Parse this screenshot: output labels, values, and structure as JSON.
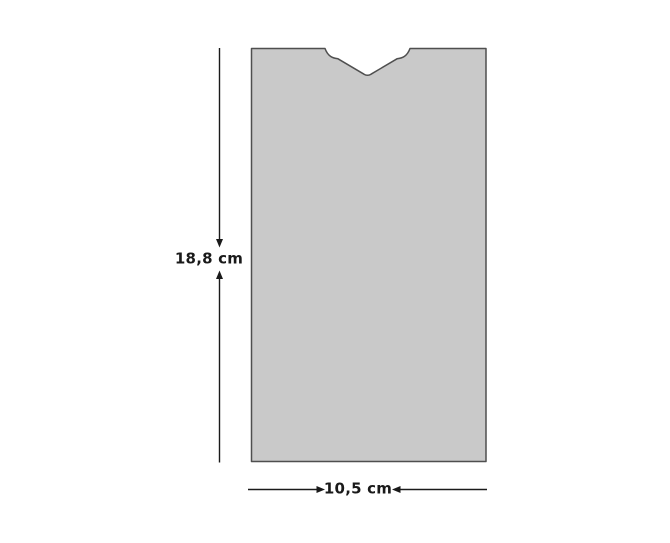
{
  "diagram": {
    "title": "notched panel with dimensions",
    "height_label": "18,8 cm",
    "width_label": "10,5 cm",
    "height_value_cm": 18.8,
    "width_value_cm": 10.5
  },
  "colors": {
    "shape_fill": "#c9c9c9",
    "shape_stroke": "#4f4f4f",
    "dimension_color": "#1a1a1a",
    "background": "#ffffff"
  }
}
